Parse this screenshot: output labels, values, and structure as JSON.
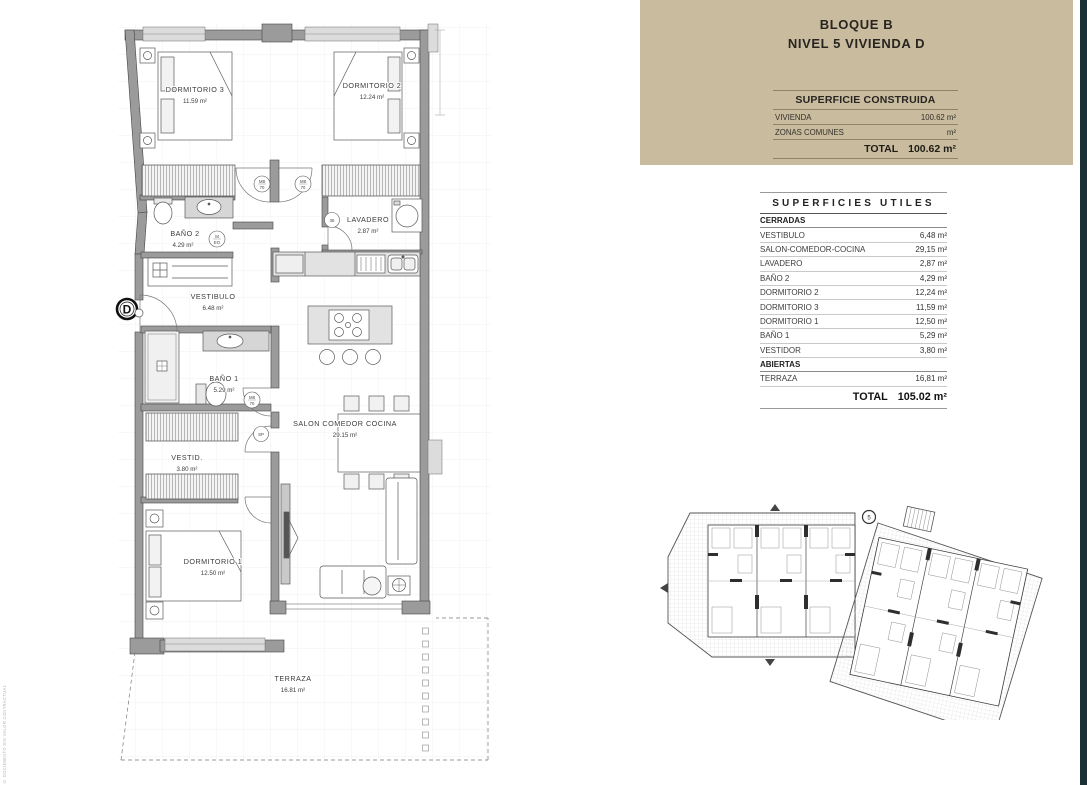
{
  "header": {
    "line1": "BLOQUE B",
    "line2": "NIVEL 5 VIVIENDA D",
    "construida": {
      "title": "SUPERFICIE CONSTRUIDA",
      "rows": [
        {
          "label": "VIVIENDA",
          "value": "100.62 m²"
        },
        {
          "label": "ZONAS COMUNES",
          "value": "m²"
        }
      ],
      "total_label": "TOTAL",
      "total_value": "100.62 m²"
    }
  },
  "utiles": {
    "title": "SUPERFICIES UTILES",
    "rows": [
      {
        "label": "CERRADAS",
        "value": ""
      },
      {
        "label": "VESTIBULO",
        "value": "6,48 m²"
      },
      {
        "label": "SALON-COMEDOR-COCINA",
        "value": "29,15 m²"
      },
      {
        "label": "LAVADERO",
        "value": "2,87 m²"
      },
      {
        "label": "BAÑO 2",
        "value": "4,29 m²"
      },
      {
        "label": "DORMITORIO 2",
        "value": "12,24 m²"
      },
      {
        "label": "DORMITORIO 3",
        "value": "11,59 m²"
      },
      {
        "label": "DORMITORIO 1",
        "value": "12,50 m²"
      },
      {
        "label": "BAÑO 1",
        "value": "5,29 m²"
      },
      {
        "label": "VESTIDOR",
        "value": "3,80 m²"
      },
      {
        "label": "ABIERTAS",
        "value": ""
      },
      {
        "label": "TERRAZA",
        "value": "16,81 m²"
      }
    ],
    "total_label": "TOTAL",
    "total_value": "105.02 m²"
  },
  "plan": {
    "rooms": [
      {
        "name": "DORMITORIO 3",
        "area": "11.59 m²"
      },
      {
        "name": "DORMITORIO 2",
        "area": "12.24 m²"
      },
      {
        "name": "BAÑO 2",
        "area": "4.29 m²"
      },
      {
        "name": "LAVADERO",
        "area": "2.87 m²"
      },
      {
        "name": "VESTIBULO",
        "area": "6.48 m²"
      },
      {
        "name": "BAÑO 1",
        "area": "5.29 m²"
      },
      {
        "name": "VESTID.",
        "area": "3.80 m²"
      },
      {
        "name": "SALON COMEDOR COCINA",
        "area": "29.15 m²"
      },
      {
        "name": "DORMITORIO 1",
        "area": "12.50 m²"
      },
      {
        "name": "TERRAZA",
        "area": "16.81 m²"
      }
    ],
    "entry_marker": "D",
    "door_codes": [
      {
        "l1": "M8",
        "l2": "70"
      },
      {
        "l1": "M8",
        "l2": "70"
      },
      {
        "l1": "35",
        "l2": ""
      },
      {
        "l1": "M",
        "l2": "EO"
      },
      {
        "l1": "M8",
        "l2": "70"
      },
      {
        "l1": "SP",
        "l2": ""
      }
    ]
  },
  "siteplan": {
    "key_marker": "5"
  },
  "watermark": "© DOCUMENTO SIN VALOR CONTRACTUAL"
}
